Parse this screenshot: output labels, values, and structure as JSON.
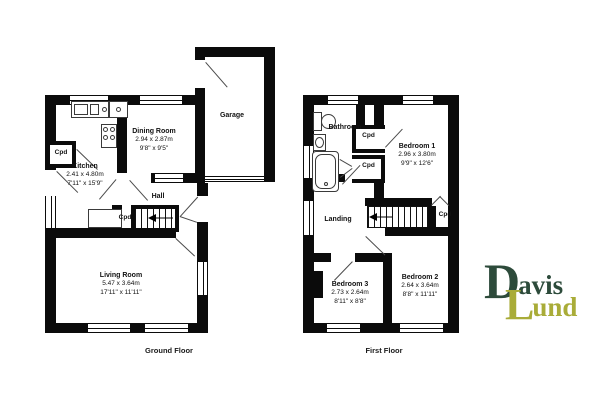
{
  "floors": {
    "ground": "Ground Floor",
    "first": "First Floor"
  },
  "labels": {
    "cpd": "Cpd"
  },
  "rooms": {
    "kitchen": {
      "name": "Kitchen",
      "metric": "2.41 x 4.80m",
      "imperial": "7'11\" x 15'9\""
    },
    "dining": {
      "name": "Dining Room",
      "metric": "2.94 x 2.87m",
      "imperial": "9'8\" x 9'5\""
    },
    "garage": {
      "name": "Garage"
    },
    "hall": {
      "name": "Hall"
    },
    "living": {
      "name": "Living Room",
      "metric": "5.47 x 3.64m",
      "imperial": "17'11\" x 11'11\""
    },
    "bathroom": {
      "name": "Bathroom"
    },
    "landing": {
      "name": "Landing"
    },
    "bedroom1": {
      "name": "Bedroom 1",
      "metric": "2.96 x 3.80m",
      "imperial": "9'9\" x 12'6\""
    },
    "bedroom2": {
      "name": "Bedroom 2",
      "metric": "2.64 x 3.64m",
      "imperial": "8'8\" x 11'11\""
    },
    "bedroom3": {
      "name": "Bedroom 3",
      "metric": "2.73 x 2.64m",
      "imperial": "8'11\" x 8'8\""
    }
  },
  "logo": {
    "d": "D",
    "avis": "avis",
    "l": "L",
    "und": "und"
  },
  "colors": {
    "wall": "#0b0b0b",
    "logo_davis": "#2d4b3b",
    "logo_lund": "#a9ac38"
  }
}
